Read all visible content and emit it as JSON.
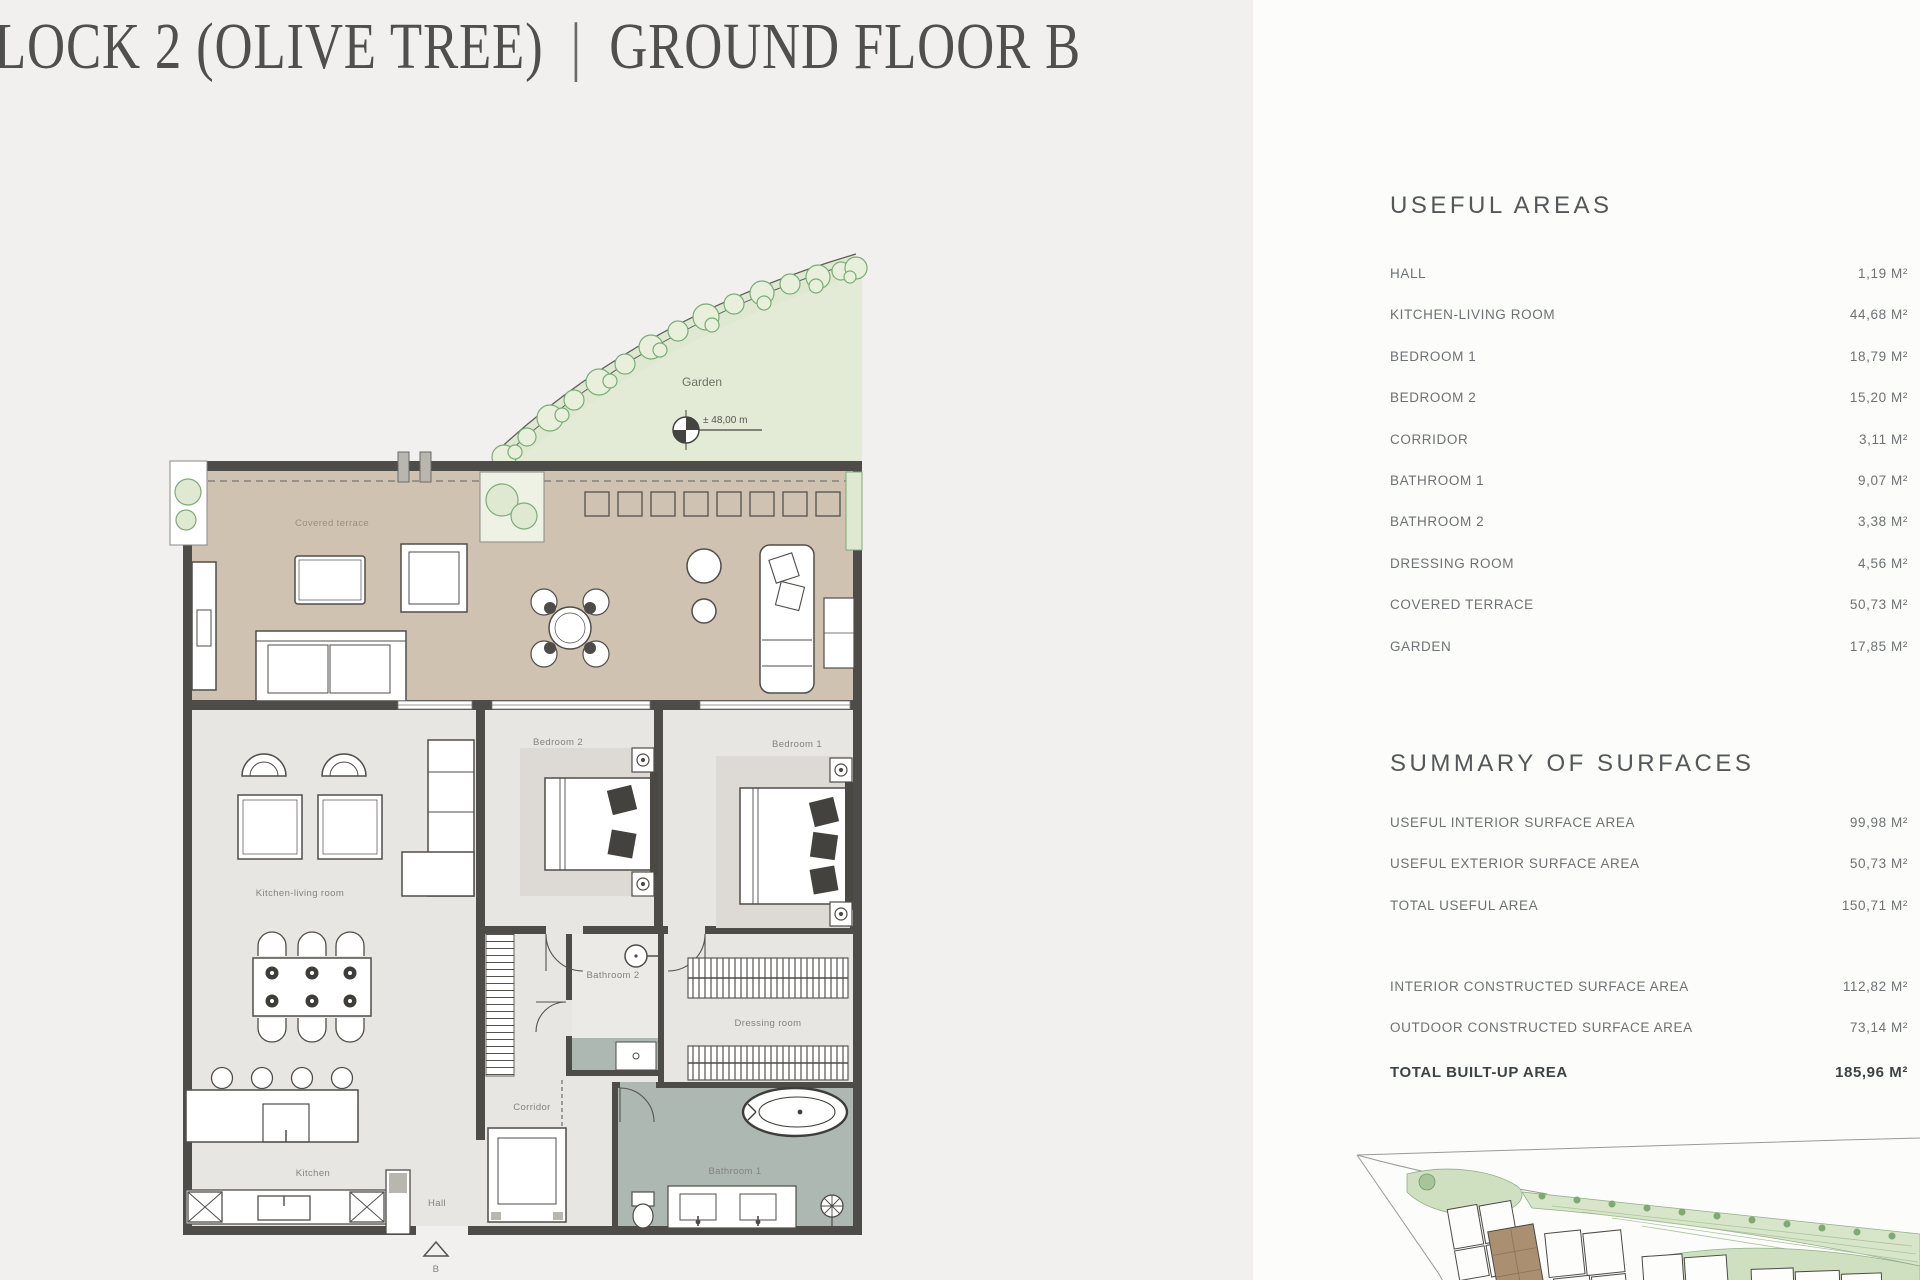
{
  "title": {
    "block": "LOCK 2 (OLIVE TREE)",
    "divider": "|",
    "floor": "GROUND FLOOR B"
  },
  "useful_areas": {
    "heading": "USEFUL AREAS",
    "rows": [
      {
        "label": "HALL",
        "value": "1,19 M²"
      },
      {
        "label": "KITCHEN-LIVING ROOM",
        "value": "44,68 M²"
      },
      {
        "label": "BEDROOM 1",
        "value": "18,79 M²"
      },
      {
        "label": "BEDROOM 2",
        "value": "15,20 M²"
      },
      {
        "label": "CORRIDOR",
        "value": "3,11 M²"
      },
      {
        "label": "BATHROOM 1",
        "value": "9,07 M²"
      },
      {
        "label": "BATHROOM 2",
        "value": "3,38 M²"
      },
      {
        "label": "DRESSING ROOM",
        "value": "4,56 M²"
      },
      {
        "label": "COVERED TERRACE",
        "value": "50,73 M²"
      },
      {
        "label": "GARDEN",
        "value": "17,85 M²"
      }
    ]
  },
  "summary": {
    "heading": "SUMMARY OF SURFACES",
    "rows": [
      {
        "label": "USEFUL INTERIOR SURFACE AREA",
        "value": "99,98 M²"
      },
      {
        "label": "USEFUL EXTERIOR SURFACE AREA",
        "value": "50,73 M²"
      },
      {
        "label": "TOTAL USEFUL AREA",
        "value": "150,71 M²"
      }
    ],
    "constructed_rows": [
      {
        "label": "INTERIOR CONSTRUCTED SURFACE AREA",
        "value": "112,82 M²"
      },
      {
        "label": "OUTDOOR CONSTRUCTED SURFACE AREA",
        "value": "73,14 M²"
      }
    ],
    "total": {
      "label": "TOTAL BUILT-UP AREA",
      "value": "185,96 M²"
    }
  },
  "plan_labels": {
    "garden": "Garden",
    "garden_level": "± 48,00 m",
    "covered_terrace": "Covered terrace",
    "bedroom_1": "Bedroom 1",
    "bedroom_2": "Bedroom 2",
    "kitchen_living": "Kitchen-living room",
    "bathroom_1": "Bathroom 1",
    "bathroom_2": "Bathroom 2",
    "dressing_room": "Dressing room",
    "corridor": "Corridor",
    "kitchen": "Kitchen",
    "hall": "Hall",
    "entrance": "B"
  },
  "colors": {
    "terrace": "#cfc2b1",
    "garden": "#e3ebd7",
    "bathroom_floor": "#adb8b3",
    "wall": "#4e4c48",
    "highlight_building": "#aa8f70"
  }
}
